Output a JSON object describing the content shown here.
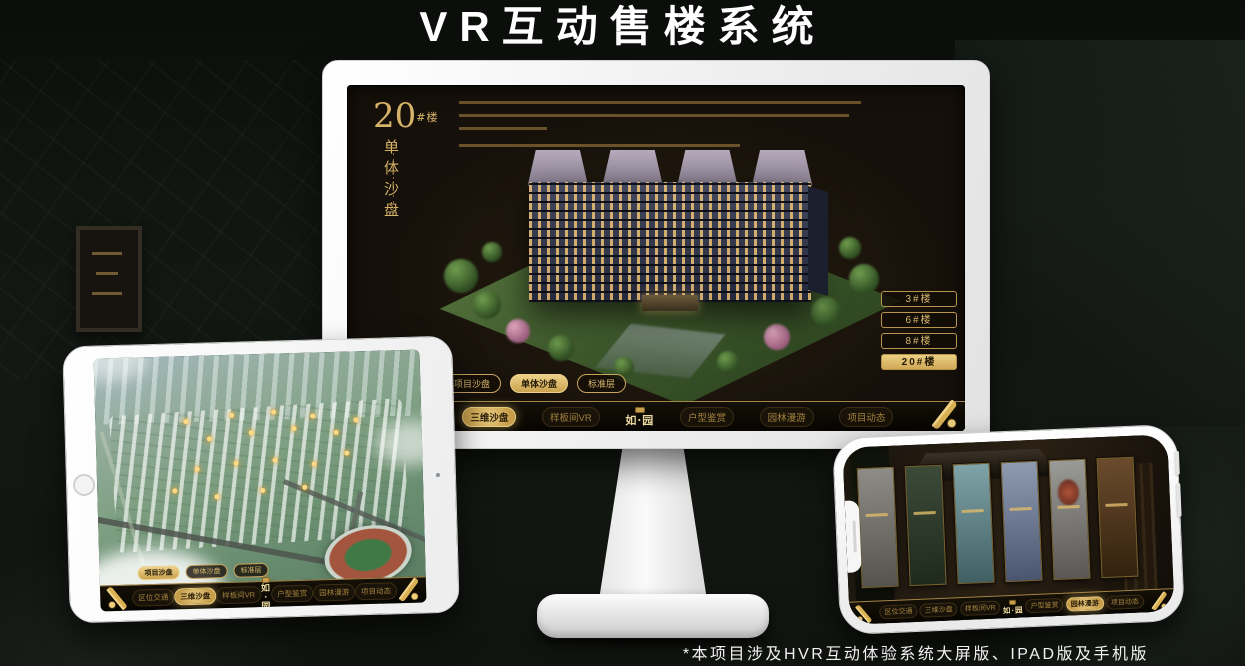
{
  "header": {
    "title": "VR互动售楼系统"
  },
  "footer": {
    "note": "*本项目涉及HVR互动体验系统大屏版、IPAD版及手机版"
  },
  "nav": {
    "logo": "如·园",
    "items": [
      "区位交通",
      "三维沙盘",
      "样板间VR",
      "户型鉴赏",
      "园林漫游",
      "项目动态"
    ]
  },
  "tabs": [
    "项目沙盘",
    "单体沙盘",
    "标准层"
  ],
  "desktop": {
    "block_number": "20",
    "block_suffix": "#楼",
    "block_subtitle": "单体沙盘",
    "floor_buttons": [
      "3#楼",
      "6#楼",
      "8#楼",
      "20#楼"
    ],
    "selected_floor": "20#楼",
    "selected_tab": "单体沙盘",
    "active_nav_item": "三维沙盘"
  },
  "tablet": {
    "selected_tab": "项目沙盘",
    "active_nav_item": "三维沙盘"
  },
  "phone": {
    "active_nav_item": "园林漫游"
  },
  "colors": {
    "accent_gold": "#cfa85a",
    "gold_bright": "#e9cb80",
    "screen_bg": "#16100a",
    "nav_bg": "#0b0804"
  }
}
